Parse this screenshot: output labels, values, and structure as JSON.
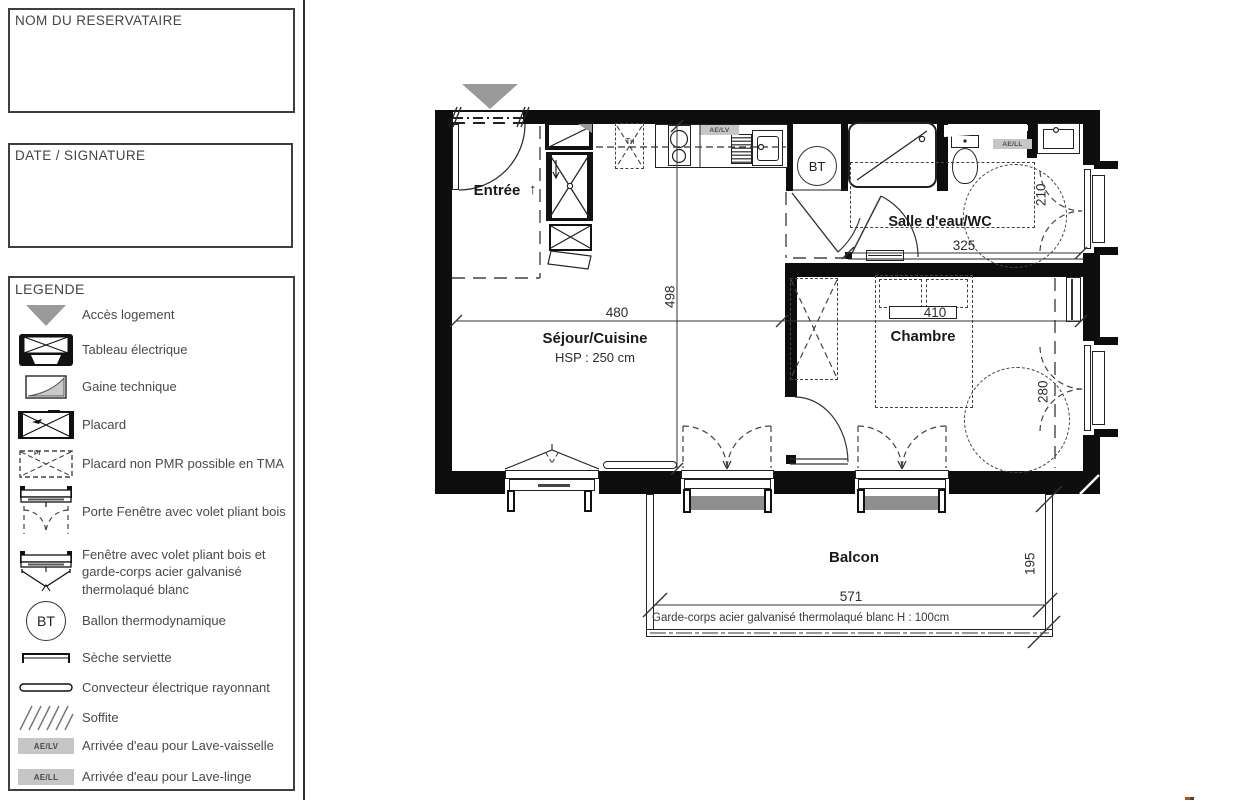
{
  "sidebar": {
    "reservataire_label": "NOM DU RESERVATAIRE",
    "date_signature_label": "DATE / SIGNATURE",
    "legend": {
      "title": "LEGENDE",
      "pi_label": "PI",
      "items": [
        {
          "icon": "access-triangle-icon",
          "label": "Accès logement"
        },
        {
          "icon": "electrical-panel-icon",
          "label": "Tableau électrique"
        },
        {
          "icon": "technical-duct-icon",
          "label": "Gaine technique"
        },
        {
          "icon": "closet-icon",
          "label": "Placard"
        },
        {
          "icon": "closet-non-pmr-icon",
          "label": "Placard non PMR possible en TMA"
        },
        {
          "icon": "french-window-icon",
          "label": "Porte Fenêtre avec volet pliant bois"
        },
        {
          "icon": "window-guardrail-icon",
          "label": "Fenêtre avec volet pliant bois et garde-corps acier galvanisé thermolaqué blanc"
        },
        {
          "icon": "bt-circle-icon",
          "label": "Ballon thermodynamique",
          "badge": "BT"
        },
        {
          "icon": "towel-dryer-icon",
          "label": "Sèche serviette"
        },
        {
          "icon": "convector-icon",
          "label": "Convecteur électrique rayonnant"
        },
        {
          "icon": "soffit-icon",
          "label": "Soffite"
        },
        {
          "icon": "water-inlet-lv-icon",
          "label": "Arrivée d'eau pour Lave-vaisselle",
          "badge": "AE/LV"
        },
        {
          "icon": "water-inlet-ll-icon",
          "label": "Arrivée d'eau pour Lave-linge",
          "badge": "AE/LL"
        }
      ]
    }
  },
  "plan": {
    "rooms": {
      "entree": "Entrée",
      "sejour": "Séjour/Cuisine",
      "sejour_hsp": "HSP : 250 cm",
      "salle_eau": "Salle d'eau/WC",
      "chambre": "Chambre",
      "balcon": "Balcon",
      "tri": "Tri"
    },
    "badges": {
      "bt": "BT",
      "ae_lv": "AE/LV",
      "ae_ll": "AE/LL"
    },
    "dimensions": {
      "sejour_width": "480",
      "sejour_depth": "498",
      "salle_eau_width": "325",
      "salle_eau_depth": "210",
      "chambre_width": "410",
      "chambre_depth": "280",
      "balcon_width": "571",
      "balcon_depth": "195"
    },
    "notes": {
      "garde_corps": "Garde-corps acier galvanisé thermolaqué blanc H : 100cm"
    },
    "icons": {
      "arrow_up": "↑"
    }
  },
  "colors": {
    "wall": "#0d0d0d",
    "access_triangle": "#9a9a9a",
    "badge_bg": "#c6c6c6",
    "shutter_panel": "#8f8f8f",
    "text": "#1f1f1f"
  }
}
